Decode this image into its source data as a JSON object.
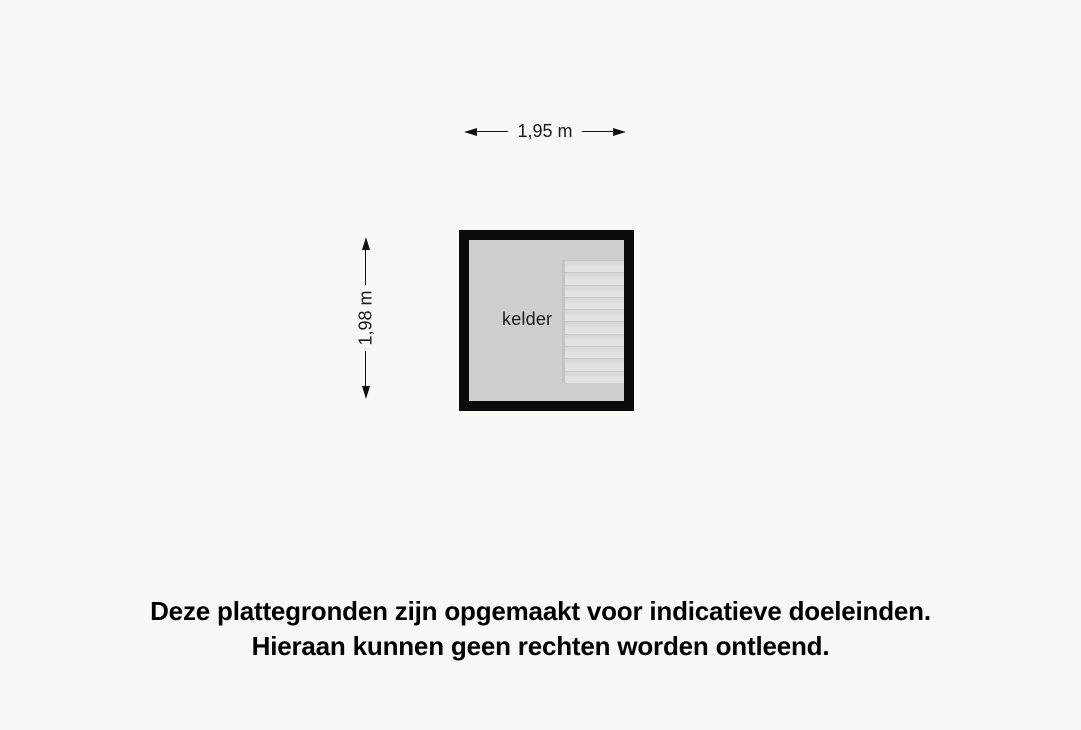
{
  "plan": {
    "room": {
      "label": "kelder"
    },
    "dimensions": {
      "width_label": "1,95 m",
      "height_label": "1,98 m"
    },
    "stairs": {
      "steps": 10
    },
    "colors": {
      "background": "#f8f8f7",
      "wall": "#0a0a0a",
      "room_fill": "#cecece",
      "stairs_fill_light": "#e2e2e2",
      "stairs_fill_dark": "#d6d6d6",
      "stairs_step_line": "#c9c9c9",
      "stairs_stringer": "#c3c3c3",
      "dimension_line": "#111111",
      "text": "#1a1a1a"
    }
  },
  "disclaimer": {
    "line1": "Deze plattegronden zijn opgemaakt voor indicatieve doeleinden.",
    "line2": "Hieraan kunnen geen rechten worden ontleend."
  }
}
